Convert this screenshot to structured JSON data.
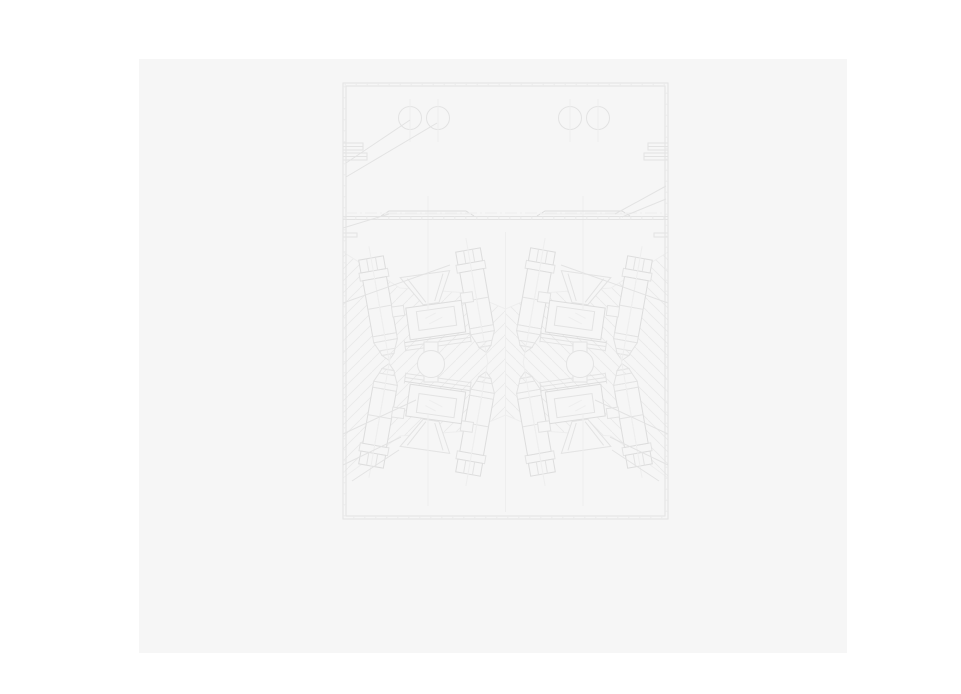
{
  "colors": {
    "canvas-bg": "#ffffff",
    "page-bg": "#f6f6f6",
    "line": "#e3e3e3",
    "line-strong": "#dddddd",
    "line-faint": "#eeeeee",
    "hatch": "#eaeaea"
  },
  "figure": {
    "kind": "engineering-section-drawing",
    "upper_circles": {
      "cy": 118,
      "r": 11.5,
      "cx": [
        410,
        438,
        570,
        598
      ]
    },
    "tappet_circles": {
      "cy": 364,
      "r": 13.5,
      "cx": [
        431,
        580
      ]
    }
  }
}
